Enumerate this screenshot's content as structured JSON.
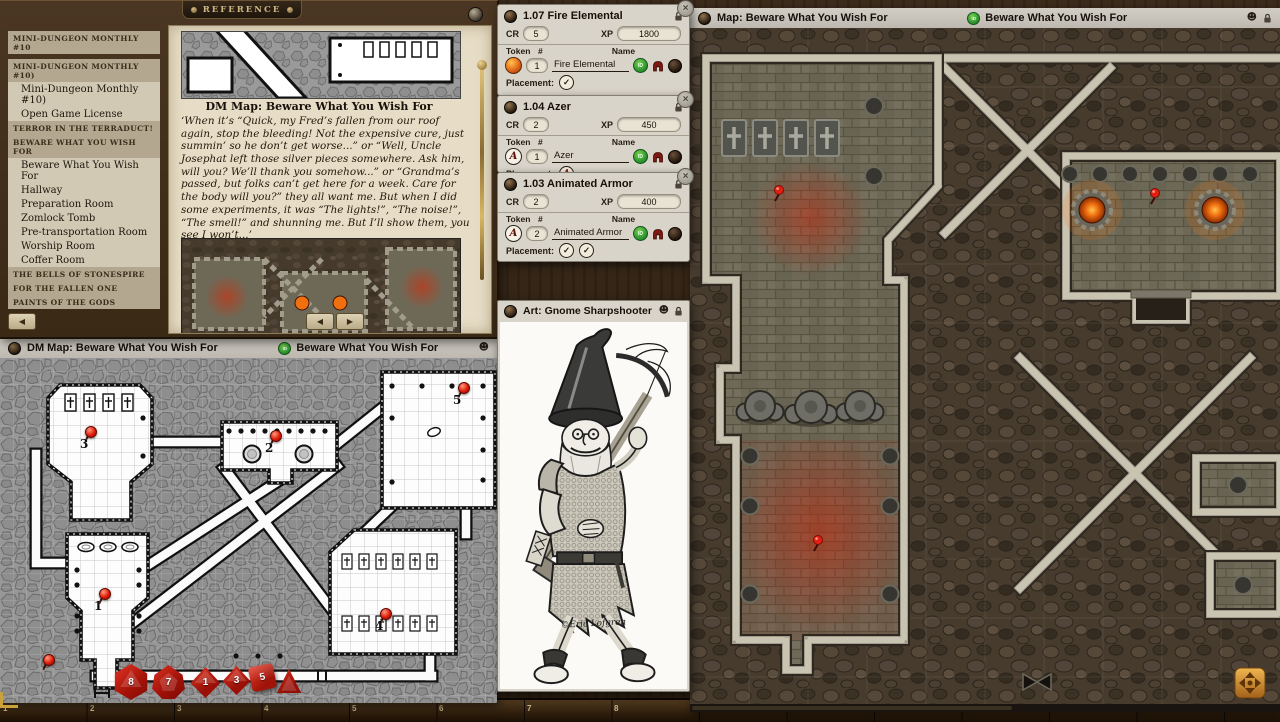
{
  "labels": {
    "cr": "CR",
    "xp": "XP",
    "token": "Token",
    "count": "#",
    "name": "Name",
    "placement": "Placement:"
  },
  "icons": {
    "close": "×",
    "check": "✓",
    "face": "☻",
    "prev": "◀",
    "next": "▶",
    "back": "◀",
    "id": "ID"
  },
  "colors": {
    "accent_green": "#2f9630",
    "pin_red": "#e01c08",
    "brazier_orange": "#f07010"
  },
  "reference_window": {
    "title": "REFERENCE",
    "sidebar": {
      "items": [
        {
          "label": "Mini-Dungeon Monthly #10"
        },
        {
          "label": "Mini-Dungeon Monthly #10)"
        },
        {
          "label": "Mini-Dungeon Monthly #10)"
        },
        {
          "label": "Open Game License"
        },
        {
          "label": "Terror in the Terraduct!"
        },
        {
          "label": "Beware What You Wish For"
        },
        {
          "label": "Beware What You Wish For"
        },
        {
          "label": "Hallway"
        },
        {
          "label": "Preparation Room"
        },
        {
          "label": "Zomlock Tomb"
        },
        {
          "label": "Pre-transportation Room"
        },
        {
          "label": "Worship Room"
        },
        {
          "label": "Coffer Room"
        },
        {
          "label": "The Bells of Stonespire"
        },
        {
          "label": "For the Fallen One"
        },
        {
          "label": "Paints of the Gods"
        }
      ]
    },
    "page": {
      "caption": "DM Map: Beware What You Wish For",
      "body": "‘When it’s “Quick, my Fred’s fallen from our roof again, stop the bleeding! Not the expensive cure, just summin’ so he don’t get worse...” or “Well, Uncle Josephat left those silver pieces somewhere. Ask him, will you? We’ll thank you somehow...” or “Grandma’s passed, but folks can’t get here for a week. Care for the body will you?” they all want me. But when I did some experiments, it was “The lights!”, “The noise!”, “The smell!” and shunning me. But I’ll show them, you see I won’t...’"
    }
  },
  "encounters": [
    {
      "title": "1.07 Fire Elemental",
      "cr": "5",
      "xp": "1800",
      "count": "1",
      "name": "Fire Elemental"
    },
    {
      "title": "1.04 Azer",
      "cr": "2",
      "xp": "450",
      "count": "1",
      "name": "Azer",
      "token_letter": "A"
    },
    {
      "title": "1.03 Animated Armor",
      "cr": "2",
      "xp": "400",
      "count": "2",
      "name": "Animated Armor",
      "token_letter": "A"
    }
  ],
  "art_window": {
    "title": "Art: Gnome Sharpshooter",
    "signature": "©Eric Lofgren"
  },
  "dm_map_window": {
    "title": "DM Map: Beware What You Wish For",
    "shared_name": "Beware What You Wish For",
    "pins": [
      {
        "label": "1"
      },
      {
        "label": "2"
      },
      {
        "label": "3"
      },
      {
        "label": "4"
      },
      {
        "label": "5"
      }
    ]
  },
  "player_map_window": {
    "title": "Map: Beware What You Wish For",
    "shared_name": "Beware What You Wish For"
  },
  "dice": [
    {
      "name": "d20",
      "value": "8"
    },
    {
      "name": "d12",
      "value": "7"
    },
    {
      "name": "d10",
      "value": "1"
    },
    {
      "name": "d8",
      "value": "3"
    },
    {
      "name": "d6",
      "value": "5"
    },
    {
      "name": "d4",
      "value": ""
    }
  ],
  "hotbar": {
    "slots": [
      "1",
      "2",
      "3",
      "4",
      "5",
      "6",
      "7",
      "8"
    ]
  }
}
